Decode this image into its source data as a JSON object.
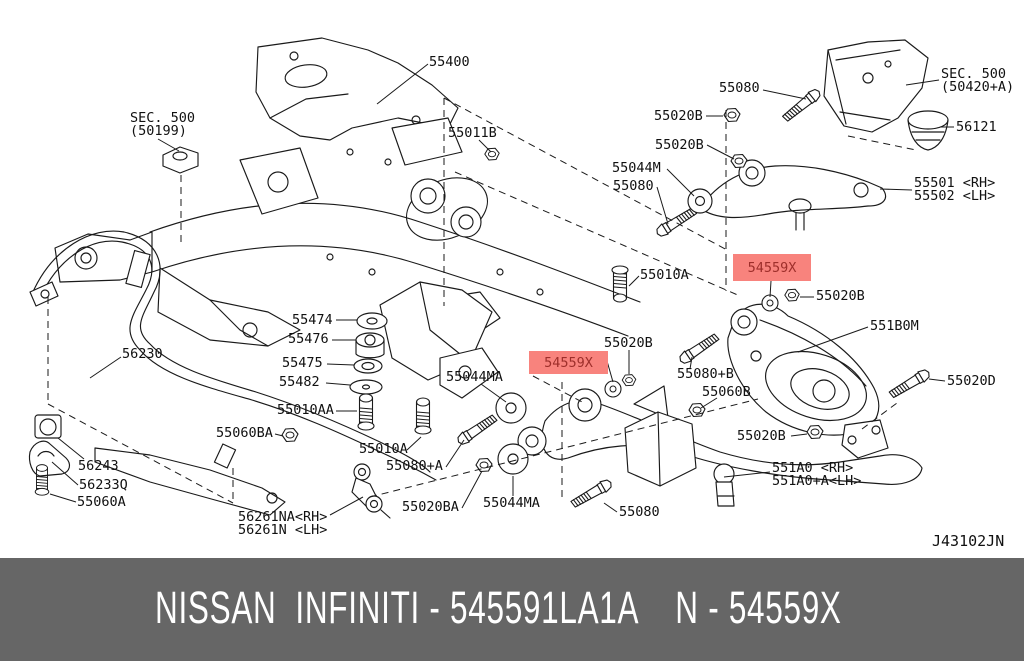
{
  "diagram": {
    "code": "J43102JN",
    "line_color": "#1a1a1a",
    "highlight_color": "#f8837d",
    "highlight_text_color": "#9e2f2b",
    "highlights": [
      {
        "text": "54559X"
      },
      {
        "text": "54559X"
      }
    ],
    "labels": [
      {
        "text": "SEC. 500\n(50199)"
      },
      {
        "text": "55400"
      },
      {
        "text": "55011B"
      },
      {
        "text": "55080"
      },
      {
        "text": "55020B"
      },
      {
        "text": "55020B"
      },
      {
        "text": "SEC. 500\n(50420+A)"
      },
      {
        "text": "56121"
      },
      {
        "text": "55044M"
      },
      {
        "text": "55080"
      },
      {
        "text": "55501 <RH>\n55502 <LH>"
      },
      {
        "text": "55010A"
      },
      {
        "text": "55020B"
      },
      {
        "text": "551B0M"
      },
      {
        "text": "55020B"
      },
      {
        "text": "55044MA"
      },
      {
        "text": "55080+B"
      },
      {
        "text": "55060B"
      },
      {
        "text": "55020D"
      },
      {
        "text": "55474"
      },
      {
        "text": "55476"
      },
      {
        "text": "55475"
      },
      {
        "text": "55482"
      },
      {
        "text": "55010AA"
      },
      {
        "text": "56230"
      },
      {
        "text": "55060BA"
      },
      {
        "text": "56243"
      },
      {
        "text": "56233Q"
      },
      {
        "text": "55060A"
      },
      {
        "text": "55010A"
      },
      {
        "text": "55080+A"
      },
      {
        "text": "56261NA<RH>\n56261N <LH>"
      },
      {
        "text": "55020BA"
      },
      {
        "text": "55044MA"
      },
      {
        "text": "55080"
      },
      {
        "text": "55020B"
      },
      {
        "text": "551A0  <RH>\n551A0+A<LH>"
      }
    ]
  },
  "footer": {
    "text": "NISSAN  INFINITI - 545591LA1A    N - 54559X",
    "background": "#666666",
    "text_color": "#ffffff"
  }
}
